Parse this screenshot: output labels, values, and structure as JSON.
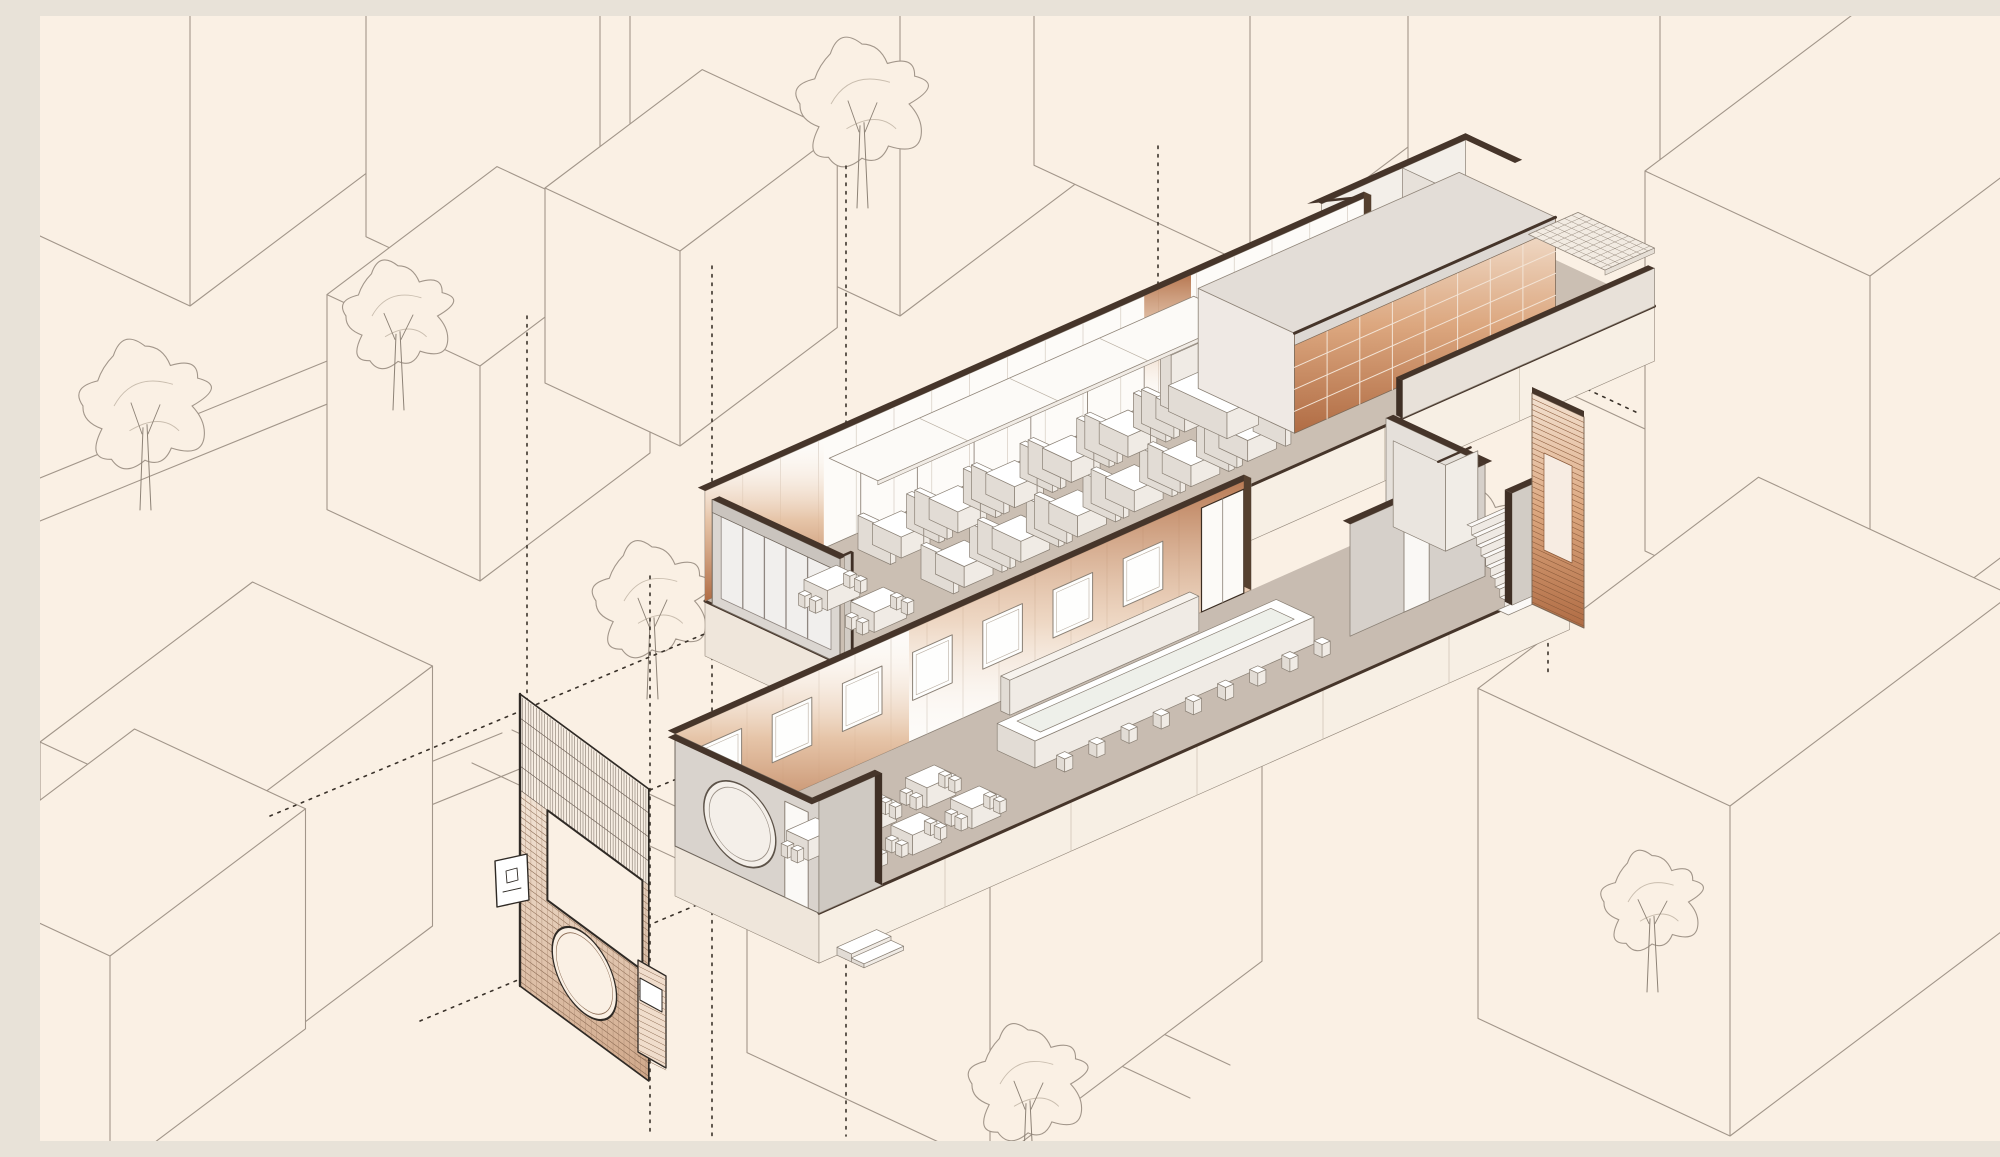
{
  "figure": {
    "kind": "axonometric-architectural-drawing",
    "subject": "exploded two-story restaurant interior with street-context blocks, trees and entry facade",
    "visible_text": ""
  },
  "palette": {
    "bg": "#faf0e4",
    "line": "#a2968a",
    "lineLight": "#c9bdae",
    "dark": "#46352a",
    "darkLine": "#3a2c21",
    "copper": "#b06c44",
    "copperMid": "#e2bb9a",
    "copperPale": "#f6e3d2",
    "wallWhite": "#fdfbf8",
    "wallGray": "#d9d3cd",
    "wallGray2": "#e9e4df",
    "floorUpper": "#cbbfb3",
    "floorLower": "#c8bcb1",
    "slabCream": "#f7efe4",
    "slabEdge": "#93877a",
    "glass": "#f1efed",
    "furnTop": "#ffffff",
    "furnFront": "#f0ebe5",
    "furnSide": "#e2dcd5",
    "furnLine": "#8a8075",
    "guide": "#3a322a"
  },
  "scene": {
    "canvas": {
      "w": 2000,
      "h": 1125
    },
    "blocks": [
      [
        150,
        290,
        300,
        230,
        340
      ],
      [
        560,
        330,
        300,
        260,
        430
      ],
      [
        860,
        300,
        320,
        300,
        520
      ],
      [
        1210,
        250,
        280,
        240,
        360
      ],
      [
        1620,
        420,
        330,
        280,
        430
      ],
      [
        1830,
        640,
        360,
        250,
        380
      ],
      [
        1690,
        1120,
        330,
        280,
        330
      ],
      [
        950,
        1150,
        320,
        270,
        300
      ],
      [
        180,
        1070,
        250,
        200,
        260
      ],
      [
        440,
        565,
        200,
        170,
        215
      ],
      [
        640,
        430,
        185,
        150,
        195
      ],
      [
        70,
        1160,
        230,
        190,
        220
      ]
    ],
    "trees": [
      [
        105,
        390,
        62
      ],
      [
        358,
        300,
        52
      ],
      [
        822,
        88,
        62
      ],
      [
        612,
        585,
        56
      ],
      [
        988,
        1068,
        56
      ],
      [
        1430,
        532,
        62
      ],
      [
        1612,
        886,
        48
      ]
    ],
    "streets": [
      [
        0,
        462,
        648,
        198
      ],
      [
        0,
        505,
        678,
        229
      ],
      [
        0,
        905,
        462,
        717
      ],
      [
        0,
        948,
        492,
        748
      ],
      [
        472,
        714,
        1190,
        1049
      ],
      [
        432,
        747,
        1150,
        1082
      ],
      [
        0,
        1022,
        248,
        920
      ]
    ],
    "guides": {
      "verticals": [
        [
          487,
          300,
          962
        ],
        [
          610,
          560,
          1118
        ],
        [
          806,
          150,
          1120
        ],
        [
          672,
          250,
          1120
        ],
        [
          1118,
          130,
          650
        ],
        [
          1508,
          330,
          660
        ]
      ],
      "diagonals": [
        [
          230,
          800,
          1290,
          356
        ],
        [
          380,
          1005,
          1060,
          720
        ],
        [
          610,
          774,
          1050,
          592
        ],
        [
          1455,
          330,
          1600,
          398
        ]
      ]
    },
    "upper_floor": {
      "origin": [
        665,
        585
      ],
      "length": 900,
      "depth": 155,
      "wall_h": 110,
      "slab_h": 55,
      "booth_start": 150,
      "booth_pitch": 63,
      "booth_clusters": 6,
      "booth_bands": [
        38,
        108
      ],
      "storefront_mullions": [
        42,
        66,
        90,
        114
      ],
      "copper_end_panel": [
        0,
        132
      ],
      "kitchen": {
        "a0": 540,
        "a1": 830,
        "b_depth": 115,
        "h": 100,
        "cols": 8,
        "rows": 4
      },
      "annex_a0": 740,
      "grid_ceiling": {
        "a0": 845,
        "a1": 900,
        "b0": 70,
        "b1": 155,
        "h": 58,
        "cell": 8
      }
    },
    "lower_floor": {
      "origin": [
        635,
        830
      ],
      "length": 834,
      "depth": 160,
      "wall_h": 112,
      "slab_h": 50,
      "windows": {
        "count": 7,
        "start": 30,
        "pitch": 78,
        "w": 44,
        "h0": 40,
        "h1": 88
      },
      "door_a": [
        585,
        632
      ],
      "kitchen_room": {
        "a0": 640,
        "a1": 790,
        "b_depth": 110
      },
      "bar": {
        "a0": 300,
        "a1": 610,
        "b0": 58,
        "b1": 100,
        "h": 27,
        "stools": 9
      },
      "tables": {
        "cols": [
          58,
          124,
          190
        ],
        "rows": [
          66,
          116
        ],
        "w": 32,
        "d": 24,
        "h": 20
      },
      "stair": {
        "a0": 762,
        "a1": 820,
        "steps": 8
      },
      "porthole": {
        "b": 72,
        "h": 52,
        "r": 40
      }
    },
    "slat_panel": {
      "pts": [
        [
          1492,
          377
        ],
        [
          1544,
          401
        ],
        [
          1544,
          612
        ],
        [
          1492,
          588
        ]
      ],
      "slat_gap": 5.5
    },
    "facade": {
      "tl": [
        480,
        678
      ],
      "axis": [
        0.805,
        0.594
      ],
      "width": 160,
      "height": 292,
      "hatch_t": 96,
      "hatch_gap": 3.4,
      "course_gap": 6.6,
      "opening": {
        "s0": 34,
        "s1": 152,
        "t0": 96,
        "t1": 186
      },
      "circle": {
        "s": 80,
        "t": 232,
        "r": 40
      },
      "sign": [
        455,
        845
      ],
      "pier": {
        "pts": [
          [
            598,
            944
          ],
          [
            626,
            960
          ],
          [
            626,
            1052
          ],
          [
            598,
            1036
          ]
        ]
      }
    }
  }
}
